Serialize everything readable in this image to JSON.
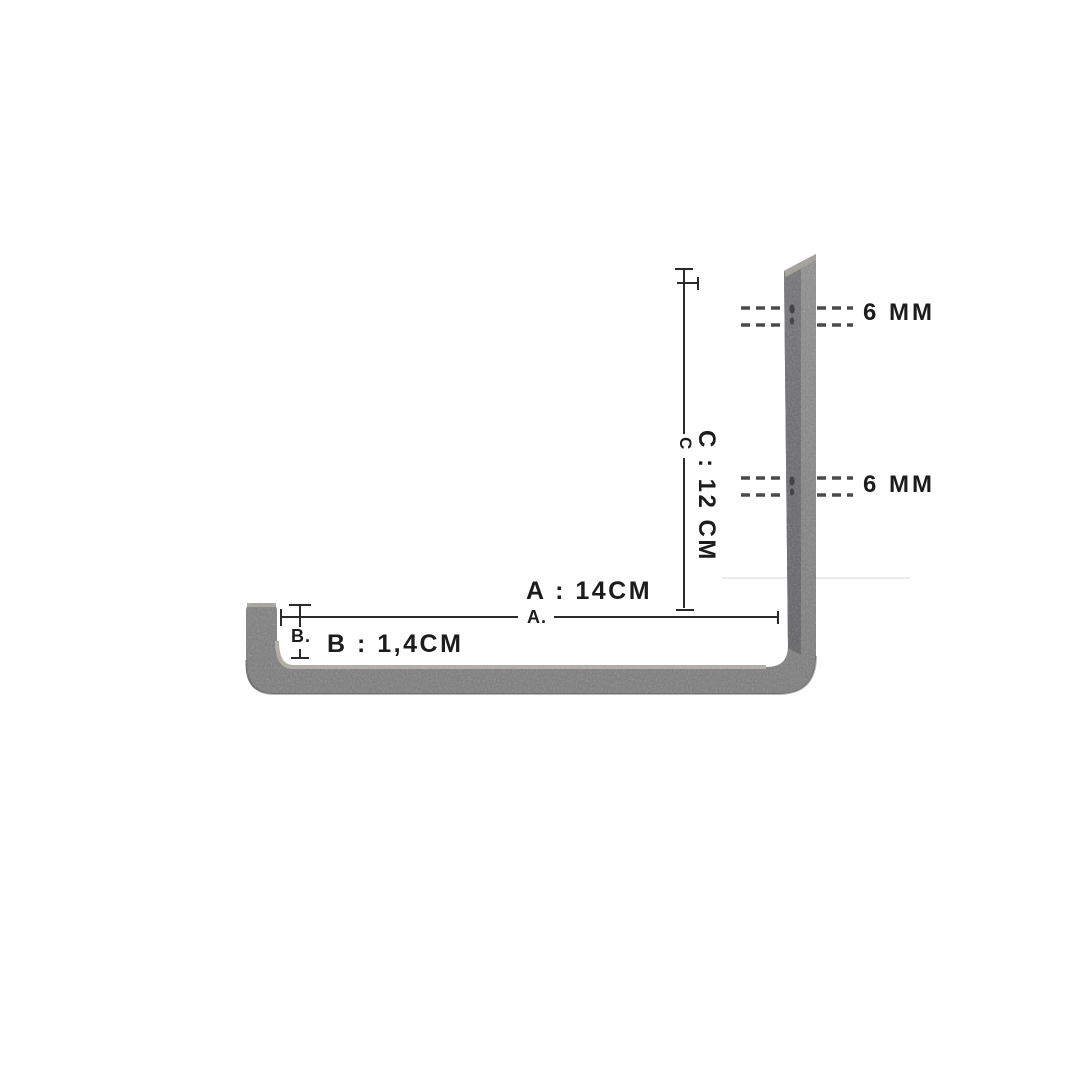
{
  "diagram": {
    "labels": {
      "hole_top": "6 MM",
      "hole_bottom": "6 MM",
      "dim_a": "A : 14CM",
      "dim_a_tick": "A.",
      "dim_b": "B : 1,4CM",
      "dim_b_tick": "B.",
      "dim_c": "C : 12 CM",
      "dim_c_tick": "C"
    },
    "colors": {
      "metal_base": "#858585",
      "metal_front": "#69696b",
      "metal_edge_highlight": "#a29e96",
      "metal_arm_highlight": "#b2aea6",
      "dimension_line": "#2b2b2b",
      "dash_line": "#4a4a4a",
      "hole": "#3a3a3e",
      "text": "#1c1c1c",
      "faint_line": "#e9ebee",
      "background": "#ffffff"
    }
  }
}
